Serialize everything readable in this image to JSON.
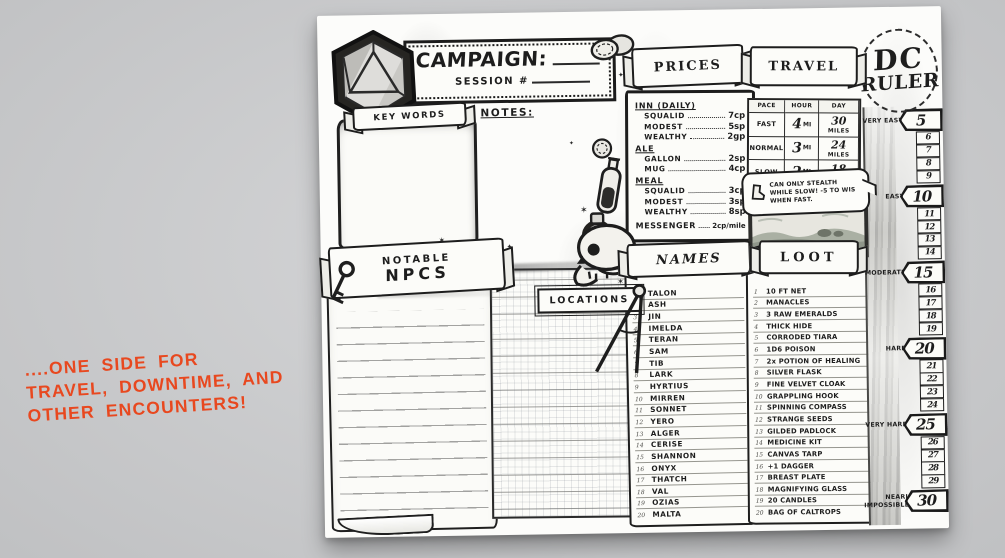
{
  "background_color": "#cacbcd",
  "ink_color": "#1d1d1d",
  "annotation": {
    "line1": "....ONE SIDE FOR",
    "line2": "TRAVEL, DOWNTIME, AND",
    "line3": "OTHER ENCOUNTERS!",
    "color": "#e8481f"
  },
  "header": {
    "campaign_label": "CAMPAIGN:",
    "session_label": "SESSION #"
  },
  "keywords": {
    "title": "KEY WORDS"
  },
  "notes_label": "NOTES:",
  "npcs": {
    "title_top": "NOTABLE",
    "title_main": "NPCS"
  },
  "locations": {
    "title": "LOCATIONS"
  },
  "prices": {
    "title": "PRICES",
    "groups": [
      {
        "heading": "INN (DAILY)",
        "items": [
          {
            "label": "SQUALID",
            "value": "7cp"
          },
          {
            "label": "MODEST",
            "value": "5sp"
          },
          {
            "label": "WEALTHY",
            "value": "2gp"
          }
        ]
      },
      {
        "heading": "ALE",
        "items": [
          {
            "label": "GALLON",
            "value": "2sp"
          },
          {
            "label": "MUG",
            "value": "4cp"
          }
        ]
      },
      {
        "heading": "MEAL",
        "items": [
          {
            "label": "SQUALID",
            "value": "3cp"
          },
          {
            "label": "MODEST",
            "value": "3sp"
          },
          {
            "label": "WEALTHY",
            "value": "8sp"
          }
        ]
      }
    ],
    "footer": {
      "label": "MESSENGER",
      "value": "2cp/mile"
    }
  },
  "travel": {
    "title": "TRAVEL",
    "columns": [
      "PACE",
      "HOUR",
      "DAY"
    ],
    "rows": [
      {
        "pace": "FAST",
        "hour_value": "4",
        "hour_unit": "MI",
        "day_value": "30",
        "day_unit": "MILES"
      },
      {
        "pace": "NORMAL",
        "hour_value": "3",
        "hour_unit": "MI",
        "day_value": "24",
        "day_unit": "MILES"
      },
      {
        "pace": "SLOW",
        "hour_value": "2",
        "hour_unit": "MI",
        "day_value": "18",
        "day_unit": "MILES"
      }
    ],
    "note": "CAN ONLY STEALTH WHILE SLOW! -5 TO WIS WHEN FAST."
  },
  "names": {
    "title": "NAMES",
    "items": [
      "TALON",
      "ASH",
      "JIN",
      "IMELDA",
      "TERAN",
      "SAM",
      "TIB",
      "LARK",
      "HYRTIUS",
      "MIRREN",
      "SONNET",
      "YERO",
      "ALGER",
      "CERISE",
      "SHANNON",
      "ONYX",
      "THATCH",
      "VAL",
      "OZIAS",
      "MALTA"
    ]
  },
  "loot": {
    "title": "LOOT",
    "items": [
      "10 FT NET",
      "MANACLES",
      "3 RAW EMERALDS",
      "THICK HIDE",
      "CORRODED TIARA",
      "1D6 POISON",
      "2x POTION OF HEALING",
      "SILVER FLASK",
      "FINE VELVET CLOAK",
      "GRAPPLING HOOK",
      "SPINNING COMPASS",
      "STRANGE SEEDS",
      "GILDED PADLOCK",
      "MEDICINE KIT",
      "CANVAS TARP",
      "+1 DAGGER",
      "BREAST PLATE",
      "MAGNIFYING GLASS",
      "20 CANDLES",
      "BAG OF CALTROPS"
    ]
  },
  "dc_ruler": {
    "title_top": "DC",
    "title_main": "RULER",
    "steps": [
      {
        "value": "5",
        "major": true,
        "label": "VERY EASY"
      },
      {
        "value": "6"
      },
      {
        "value": "7"
      },
      {
        "value": "8"
      },
      {
        "value": "9"
      },
      {
        "value": "10",
        "major": true,
        "label": "EASY"
      },
      {
        "value": "11"
      },
      {
        "value": "12"
      },
      {
        "value": "13"
      },
      {
        "value": "14"
      },
      {
        "value": "15",
        "major": true,
        "label": "MODERATE"
      },
      {
        "value": "16"
      },
      {
        "value": "17"
      },
      {
        "value": "18"
      },
      {
        "value": "19"
      },
      {
        "value": "20",
        "major": true,
        "label": "HARD"
      },
      {
        "value": "21"
      },
      {
        "value": "22"
      },
      {
        "value": "23"
      },
      {
        "value": "24"
      },
      {
        "value": "25",
        "major": true,
        "label": "VERY HARD"
      },
      {
        "value": "26"
      },
      {
        "value": "27"
      },
      {
        "value": "28"
      },
      {
        "value": "29"
      },
      {
        "value": "30",
        "major": true,
        "label": "NEARLY IMPOSSIBLE"
      }
    ]
  },
  "icons": {
    "star": "✶",
    "sparkle": "✦"
  },
  "decorations": [
    "d20-die",
    "coins",
    "coin",
    "potion-bottle",
    "iron-ring",
    "skull",
    "key",
    "drafting-compass",
    "boot",
    "landscape-sketch"
  ]
}
